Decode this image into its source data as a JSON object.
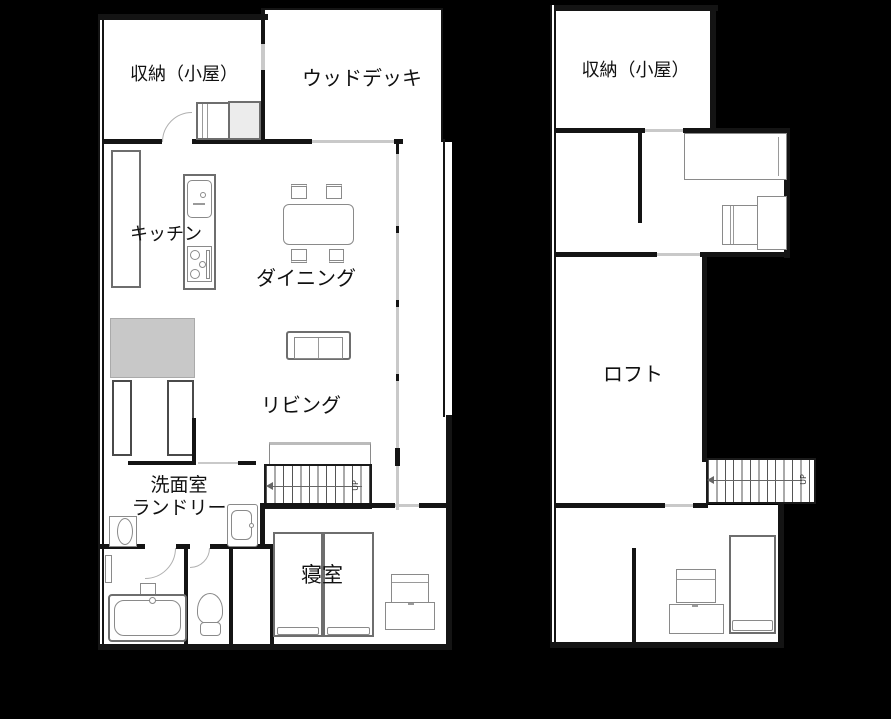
{
  "colors": {
    "background": "#000000",
    "floor": "#ffffff",
    "wall": "#141414",
    "window_line": "#c9c9c9",
    "furniture_line": "#8a8a8a",
    "closet_fill": "#c8c8c8"
  },
  "floor1": {
    "storage_label": "収納（小屋）",
    "deck_label": "ウッドデッキ",
    "kitchen_label": "キッチン",
    "dining_label": "ダイニング",
    "living_label": "リビング",
    "washroom_label_line1": "洗面室",
    "washroom_label_line2": "ランドリー",
    "bedroom_label": "寝室",
    "stairs_label": "UP"
  },
  "floor2": {
    "storage_label": "収納（小屋）",
    "loft_label": "ロフト",
    "stairs_label": "UP"
  }
}
